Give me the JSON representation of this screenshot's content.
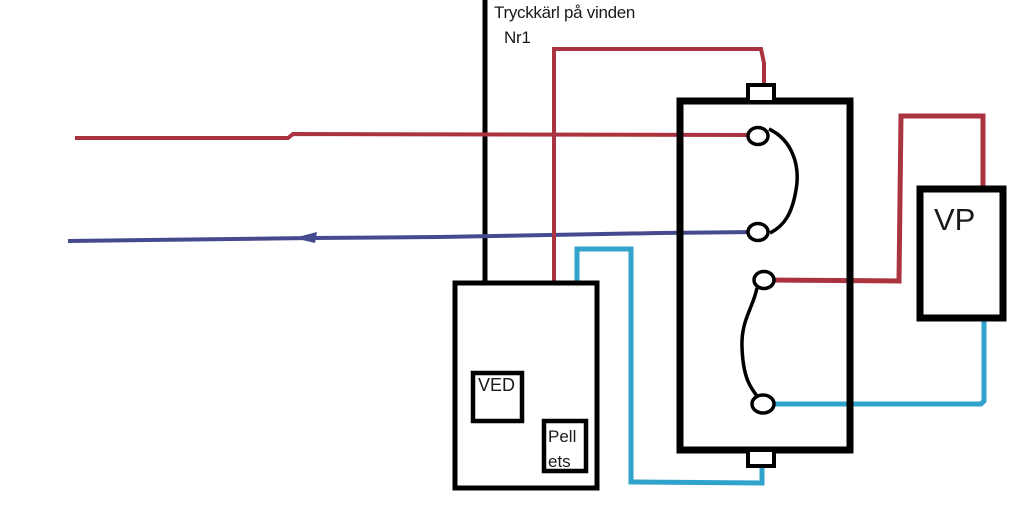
{
  "diagram": {
    "title": {
      "line1": "Tryckkärl på vinden",
      "line2": "Nr1"
    },
    "boiler": {
      "fuel_wood_label": "VED",
      "fuel_pellets_line1": "Pell",
      "fuel_pellets_line2": "ets"
    },
    "heat_pump": {
      "label": "VP"
    },
    "colors": {
      "pipe_hot": "#aa333f",
      "pipe_return": "#45498e",
      "pipe_cold": "#30a2cc",
      "pipe_black": "#000000"
    }
  }
}
